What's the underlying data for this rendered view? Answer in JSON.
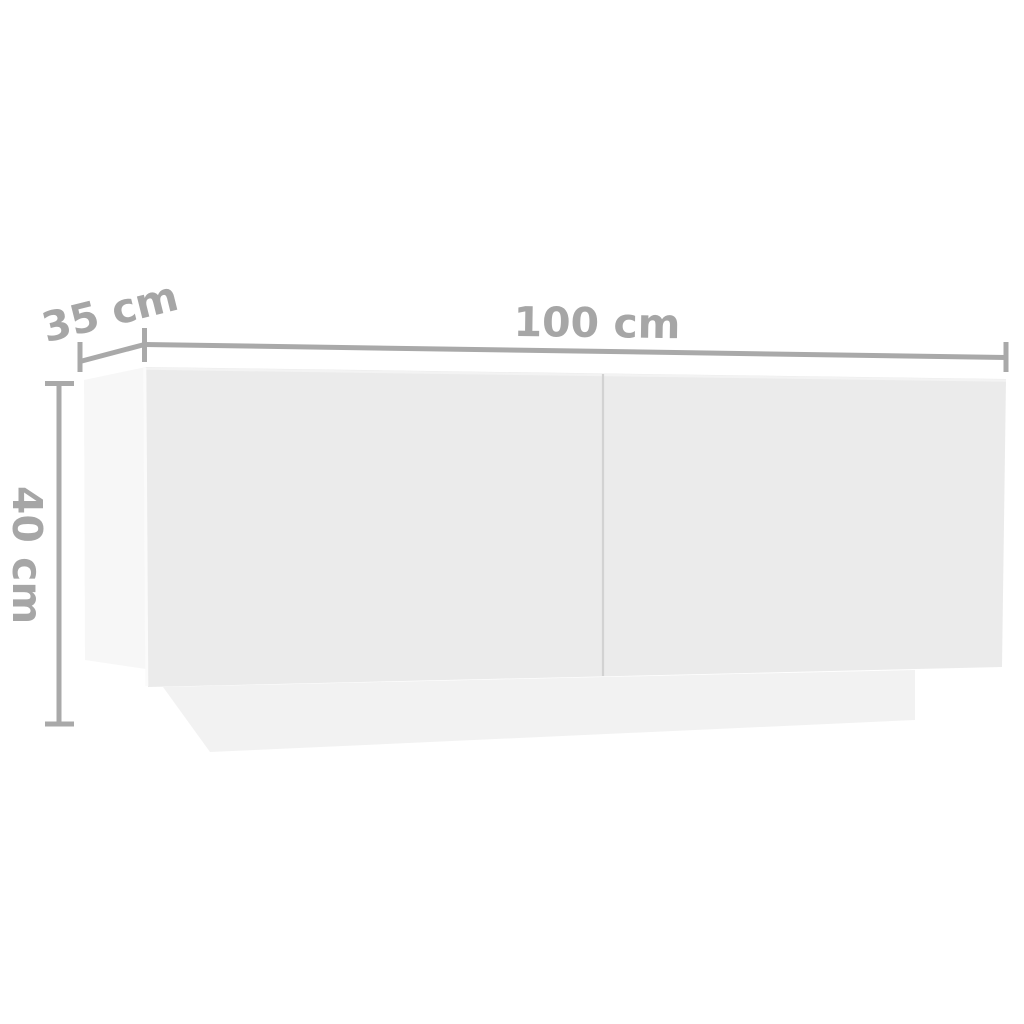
{
  "diagram": {
    "kind": "furniture-dimension-diagram",
    "dimension_labels": {
      "width": "100 cm",
      "depth": "35 cm",
      "height": "40 cm"
    },
    "colors": {
      "background": "#ffffff",
      "dimension_line": "#a9a9a9",
      "dimension_text": "#a6a6a6",
      "front_face": "#ebebeb",
      "side_panel": "#f7f7f7",
      "plinth": "#f2f2f2",
      "door_seam": "#d2d2d2",
      "edge_highlight": "#fbfbfb",
      "face_top_highlight": "#f3f3f3"
    }
  }
}
